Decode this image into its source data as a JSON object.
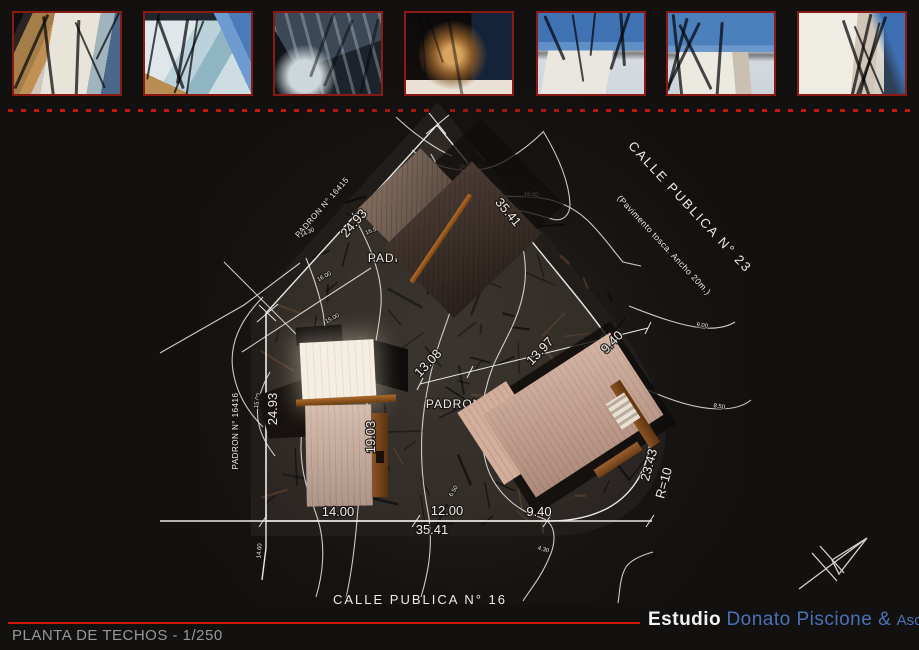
{
  "colors": {
    "accent_red": "#c21712",
    "studio_blue": "#4a72b8",
    "line_white": "#ebe8e3",
    "lot_fill": "#37302b",
    "background": "#131110"
  },
  "photos": {
    "count": 7,
    "description": "model-photograph"
  },
  "footer": {
    "title": "PLANTA DE TECHOS - 1/250",
    "studio_bold": "Estudio",
    "studio_name": "Donato Piscione &",
    "studio_suffix": "Asoc."
  },
  "plan": {
    "streets": [
      {
        "text": "CALLE PUBLICA N° 23",
        "x": 687,
        "y": 210,
        "rot": 47,
        "cls": "t-street"
      },
      {
        "text": "(Pavimento tosca. Ancho 20m.)",
        "x": 662,
        "y": 247,
        "rot": 47,
        "cls": "t-street-sub"
      },
      {
        "text": "CALLE PUBLICA N° 16",
        "x": 420,
        "y": 604,
        "rot": 0,
        "cls": "t-street"
      }
    ],
    "padrones": [
      {
        "text": "PADRON N° 16415",
        "x": 324,
        "y": 209,
        "rot": -49,
        "cls": "t-padron"
      },
      {
        "text": "PADRON N° 16416",
        "x": 238,
        "y": 431,
        "rot": -90,
        "cls": "t-padron"
      },
      {
        "text": "PADRON N° 1",
        "x": 412,
        "y": 262,
        "rot": 0,
        "cls": "t-padron-big"
      },
      {
        "text": "PADRON",
        "x": 310,
        "y": 433,
        "rot": 0,
        "cls": "t-padron-big"
      },
      {
        "text": "PADRON N°",
        "x": 464,
        "y": 408,
        "rot": 0,
        "cls": "t-padron-big"
      }
    ],
    "dimensions": [
      {
        "t": "24.93",
        "x": 357,
        "y": 226,
        "rot": -49,
        "fs": 13
      },
      {
        "t": "35.41",
        "x": 505,
        "y": 215,
        "rot": 50,
        "fs": 13
      },
      {
        "t": "24.93",
        "x": 277,
        "y": 409,
        "rot": -90,
        "fs": 13
      },
      {
        "t": "35.41",
        "x": 432,
        "y": 534,
        "rot": 0,
        "fs": 12
      },
      {
        "t": "23.43",
        "x": 653,
        "y": 466,
        "rot": -75,
        "fs": 10
      },
      {
        "t": "R=10",
        "x": 668,
        "y": 484,
        "rot": -75,
        "fs": 10
      },
      {
        "t": "19.03",
        "x": 375,
        "y": 437,
        "rot": -90,
        "fs": 8
      },
      {
        "t": "13.08",
        "x": 431,
        "y": 366,
        "rot": -46,
        "fs": 8
      },
      {
        "t": "13.97",
        "x": 543,
        "y": 354,
        "rot": -46,
        "fs": 8
      },
      {
        "t": "9.40",
        "x": 615,
        "y": 345,
        "rot": -46,
        "fs": 8
      },
      {
        "t": "14.00",
        "x": 338,
        "y": 516,
        "rot": 0,
        "fs": 7
      },
      {
        "t": "12.00",
        "x": 447,
        "y": 515,
        "rot": 0,
        "fs": 7
      },
      {
        "t": "9.40",
        "x": 539,
        "y": 516,
        "rot": 0,
        "fs": 7
      }
    ],
    "contour_labels": [
      {
        "t": "16.50",
        "x": 466,
        "y": 167,
        "rot": -15
      },
      {
        "t": "16.00",
        "x": 531,
        "y": 196,
        "rot": 5
      },
      {
        "t": "14.50",
        "x": 469,
        "y": 194,
        "rot": -48
      },
      {
        "t": "16.50",
        "x": 373,
        "y": 232,
        "rot": -20
      },
      {
        "t": "14.30",
        "x": 308,
        "y": 234,
        "rot": -25
      },
      {
        "t": "16.00",
        "x": 325,
        "y": 278,
        "rot": -28
      },
      {
        "t": "15.00",
        "x": 333,
        "y": 320,
        "rot": -28
      },
      {
        "t": "15.00",
        "x": 259,
        "y": 401,
        "rot": -80
      },
      {
        "t": "15.50",
        "x": 523,
        "y": 232,
        "rot": -45
      },
      {
        "t": "17.00",
        "x": 446,
        "y": 297,
        "rot": -50
      },
      {
        "t": "9.00",
        "x": 702,
        "y": 327,
        "rot": 8
      },
      {
        "t": "8.50",
        "x": 719,
        "y": 408,
        "rot": 8
      },
      {
        "t": "6.50",
        "x": 455,
        "y": 492,
        "rot": -60
      },
      {
        "t": "4.30",
        "x": 543,
        "y": 551,
        "rot": 15
      },
      {
        "t": "14.60",
        "x": 261,
        "y": 551,
        "rot": -85
      }
    ]
  }
}
